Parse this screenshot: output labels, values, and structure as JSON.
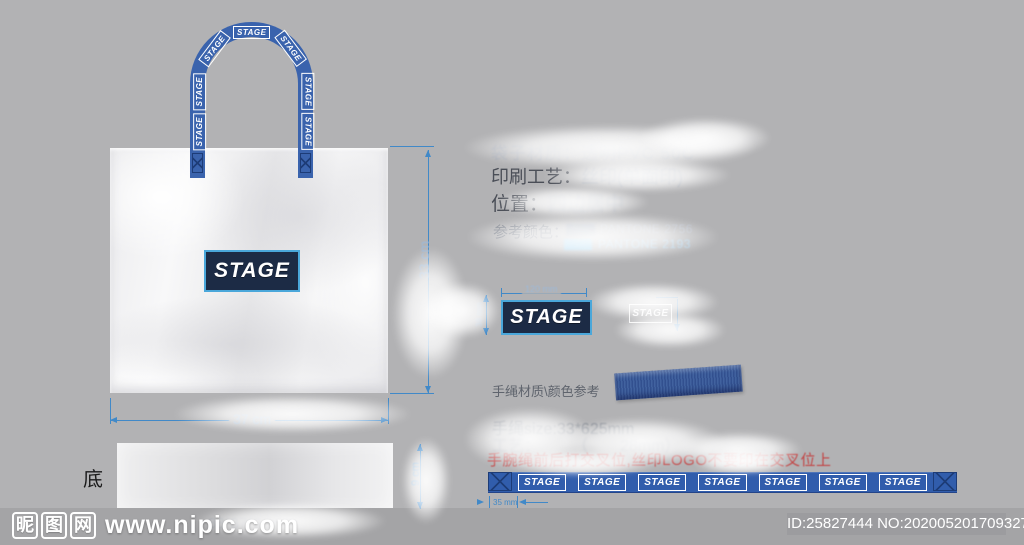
{
  "colors": {
    "background": "#b2b2b4",
    "footer_background": "#a4a4a6",
    "handle_blue": "#3a63ad",
    "ribbon_blue": "#315dac",
    "logo_navy": "#1c2b45",
    "logo_cyan_border": "#4aa7da",
    "dimension_blue": "#4189c8",
    "warning_red": "#c24444"
  },
  "brand": {
    "logo": "STAGE"
  },
  "bag": {
    "front_logo": "STAGE",
    "handle_labels": [
      "STAGE",
      "STAGE",
      "STAGE",
      "STAGE",
      "STAGE",
      "STAGE",
      "STAGE"
    ]
  },
  "dimensions": {
    "bag_width": "37 cm",
    "bag_height": "33 cm",
    "logo_width": "120 mm",
    "logo_height": "38 mm",
    "ribbon_offset": "35 mm",
    "bottom_height": "9 cm",
    "bag_size": "33*37*9cm"
  },
  "specs": {
    "material_label": "袋子材质：",
    "material_value": "透明PVC 50C",
    "printing_label": "印刷工艺：",
    "printing_value": "丝印(单面印)",
    "position_label": "位置：",
    "position_value": "四边居中",
    "color_ref_label": "参考颜色：",
    "pantone_1": {
      "name": "PANTONE 2756",
      "hex": "#98a0ad"
    },
    "pantone_2": {
      "name": "PANTONE 2193",
      "hex": "#8cc8ea"
    }
  },
  "logo_detail": {
    "print_text": "STAGE",
    "outline_text": "STAGE"
  },
  "handle_spec": {
    "material_label": "手绳材质\\颜色参考",
    "size_line": "手绳size:33*625mm",
    "process_line": "工艺：　　　（　　28mm）",
    "warning_line": "手腕绳前后打交叉位,丝印LOGO不要印在交叉位上"
  },
  "ribbon": {
    "labels": [
      "STAGE",
      "STAGE",
      "STAGE",
      "STAGE",
      "STAGE",
      "STAGE",
      "STAGE"
    ]
  },
  "bottom_panel": {
    "label": "底"
  },
  "footer": {
    "site_chars": [
      "昵",
      "图",
      "网"
    ],
    "site_url": "www.nipic.com",
    "id_text": "ID:25827444 NO:20200520170932707422"
  }
}
